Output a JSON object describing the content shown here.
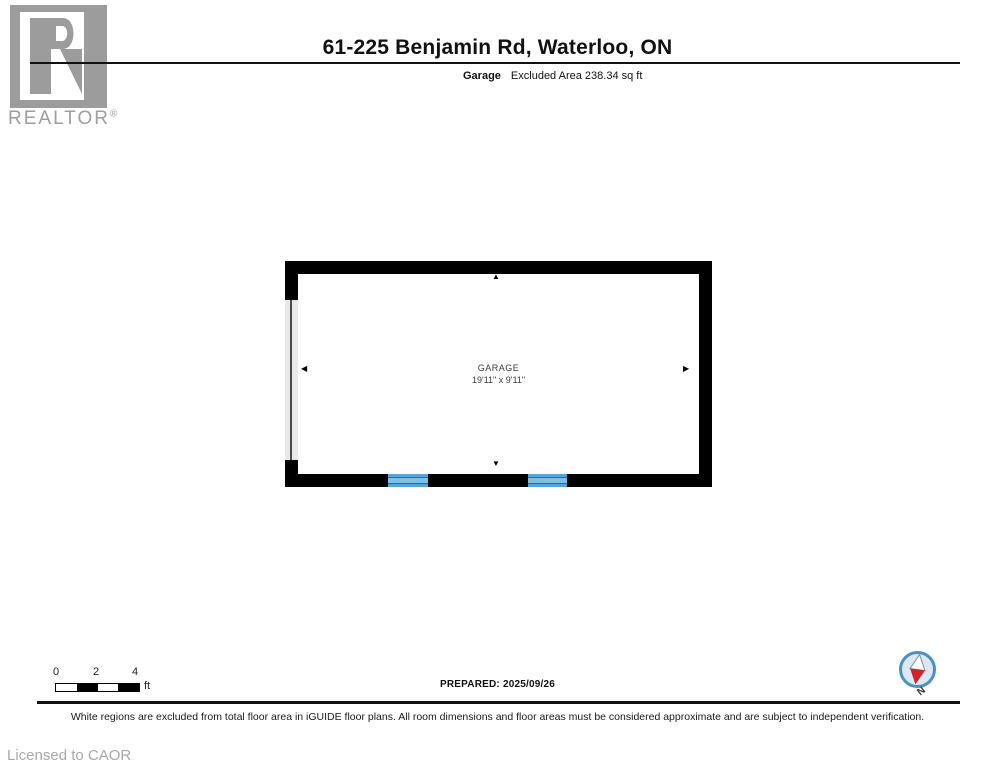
{
  "header": {
    "logo": {
      "brand": "REALTOR",
      "registered": "®"
    },
    "title": "61-225 Benjamin Rd, Waterloo, ON",
    "subtitle": {
      "room": "Garage",
      "area": "Excluded Area 238.34 sq ft"
    }
  },
  "plan": {
    "room_name": "GARAGE",
    "room_dimensions": "19'11\" x 9'11\"",
    "features": [
      "garage-door-left-wall",
      "window-bottom-left",
      "window-bottom-right"
    ],
    "colors": {
      "wall": "#000000",
      "garage_door": "#e9e9e9",
      "window_blue": "#51a7dd",
      "window_line": "#1d6ca6"
    }
  },
  "icons": {
    "arrow_up": "▲",
    "arrow_down": "▼",
    "arrow_left": "◀",
    "arrow_right": "▶"
  },
  "scale_bar": {
    "ticks": [
      "0",
      "2",
      "4"
    ],
    "unit": "ft"
  },
  "compass": {
    "label": "N",
    "ring_color": "#4a90c8",
    "fill_color": "#d9e9f5",
    "needle_red": "#d6202a"
  },
  "footer": {
    "prepared_label": "PREPARED:",
    "prepared_date": "2025/09/26",
    "disclaimer": "White regions are excluded from total floor area in iGUIDE floor plans. All room dimensions and floor areas must be considered approximate and are subject to independent verification.",
    "license": "Licensed to CAOR"
  },
  "brand_colors": {
    "logo_gray": "#9c9c9c",
    "text_gray": "#9e9e9e"
  }
}
